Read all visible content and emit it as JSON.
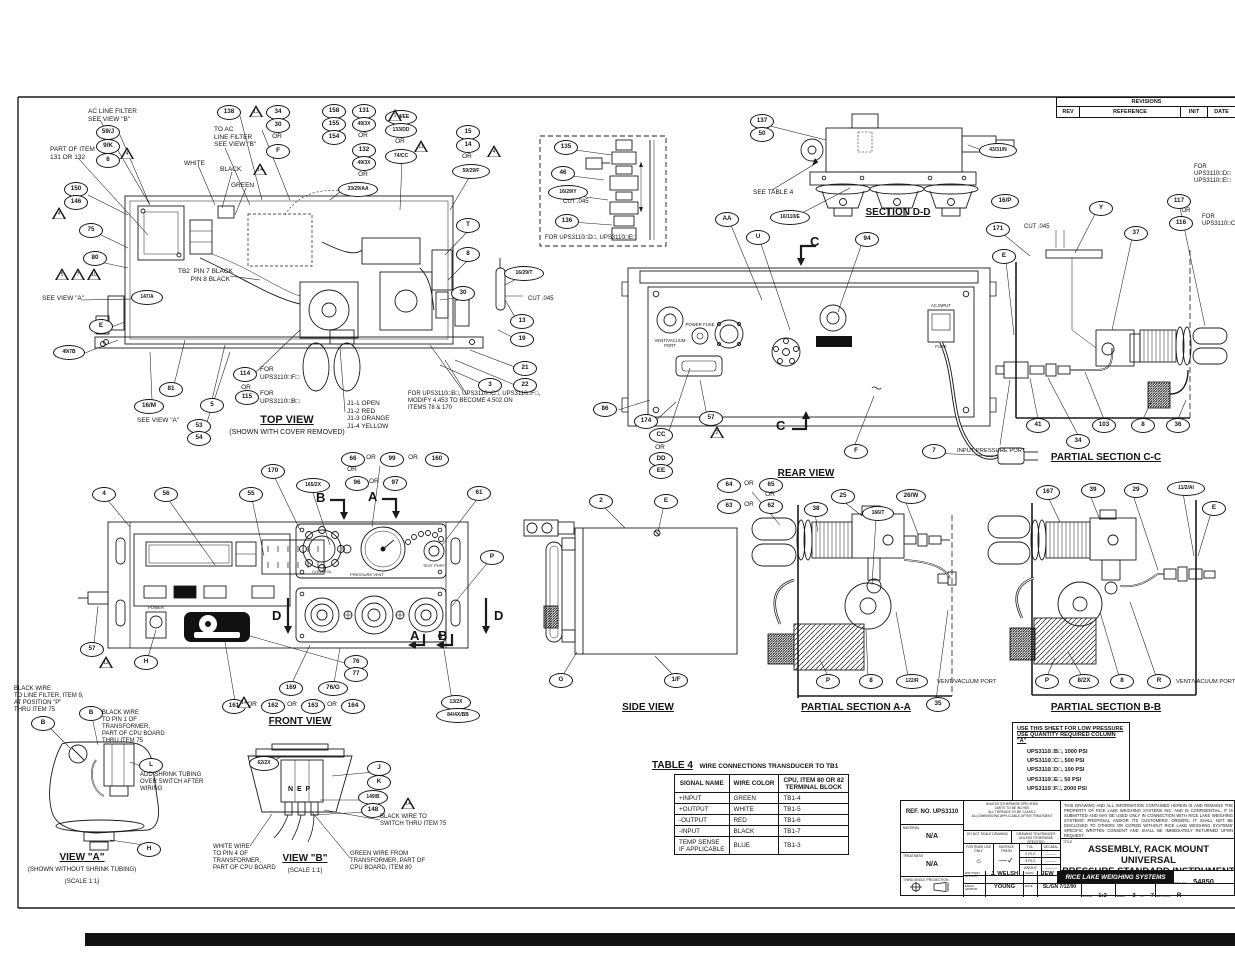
{
  "revisions": {
    "title": "REVISIONS",
    "cols": [
      "REV",
      "REFERENCE",
      "INIT",
      "DATE"
    ]
  },
  "table4": {
    "title": "TABLE 4",
    "subtitle": "WIRE CONNECTIONS TRANSDUCER TO TB1",
    "headers": [
      "SIGNAL NAME",
      "WIRE COLOR",
      "CPU, ITEM 80 OR 82\nTERMINAL BLOCK"
    ],
    "rows": [
      [
        "+INPUT",
        "GREEN",
        "TB1-4"
      ],
      [
        "+OUTPUT",
        "WHITE",
        "TB1-5"
      ],
      [
        "-OUTPUT",
        "RED",
        "TB1-6"
      ],
      [
        "-INPUT",
        "BLACK",
        "TB1-7"
      ],
      [
        "TEMP SENSE\nIF APPLICABLE",
        "BLUE",
        "TB1-3"
      ]
    ]
  },
  "low_pressure": {
    "header1": "USE THIS SHEET FOR LOW PRESSURE",
    "header2": "USE QUANTITY REQUIRED COLUMN \"A\"",
    "items": [
      "UPS3110□B□, 1000 PSI",
      "UPS3110□C□, 500 PSI",
      "UPS3110□D□, 100 PSI",
      "UPS3110□E□, 50 PSI",
      "UPS3110□F□, 2000 PSI"
    ]
  },
  "title_block": {
    "ref_no": "REF. NO. UPS3110",
    "material_label": "MATERIAL",
    "material": "N/A",
    "treatment_label": "TREATMENT",
    "treatment": "N/A",
    "projection_label": "THIRD ANGLE PROJECTION",
    "spec_note": "UNLESS OTHERWISE SPECIFIED\nLIMITS TO BE INCHES\nALL THREADS TO BE CLASS 2\nALL DIMENSIONS APPLICABLE AFTER TREATMENT",
    "do_not_scale": "DO NOT SCALE DRAWING",
    "tolerances_header": "DRAWING TOLERANCES UNLESS OTHERWISE SPECIFIED",
    "rlws_use": "FOR RLWS USE ONLY",
    "surface_finish": "SURFACE FINISH",
    "tol_label": "TOL.",
    "decimal_label": "DECIMAL",
    "tol_rows": [
      [
        "2 PLC",
        "———"
      ],
      [
        "3 PLC",
        "———"
      ],
      [
        "ANGLE",
        "———"
      ]
    ],
    "legal": "THIS DRAWING AND ALL INFORMATION CONTAINED HEREIN IS AND REMAINS THE PROPERTY OF RICE LAKE WEIGHING SYSTEMS INC. AND IS CONFIDENTIAL. IT IS SUBMITTED AND MAY BE USED ONLY IN CONNECTION WITH RICE LAKE WEIGHING SYSTEMS' PROPOSAL AND/OR ITS CUSTOMERS' ORDERS. IT SHALL NOT BE DISCLOSED TO OTHERS OR COPIED WITHOUT RICE LAKE WEIGHING SYSTEMS' SPECIFIC WRITTEN CONSENT AND SHALL BE IMMEDIATELY RETURNED UPON REQUEST.",
    "title_label": "TITLE",
    "title_line1": "ASSEMBLY, RACK MOUNT UNIVERSAL",
    "title_line2": "PRESSURE STANDARD INSTRUMENT",
    "company": "RICE LAKE WEIGHING SYSTEMS",
    "dwg_no_label": "DWG NO",
    "dwg_no": "54850",
    "drftsmn_label": "DRFTSMN APPRVD",
    "drftsmn": "J. WELSH",
    "chk_label": "CHKD",
    "chk": "JEW",
    "engr_label": "ENGR APPRVD",
    "engr": "YOUNG",
    "date_label": "DATE",
    "date": "SL/GN 7/12/90",
    "scale_label": "SCALE",
    "scale": "1:2",
    "sheet_label": "SHEET",
    "sheet": "3",
    "of_label": "OF",
    "sheet_total": "7",
    "revision_label": "REVISION",
    "revision": "R"
  },
  "annotations": [
    {
      "t": "AC LINE FILTER\nSEE VIEW \"B\"",
      "x": 88,
      "y": 108
    },
    {
      "t": "PART OF ITEM\n131 OR 132",
      "x": 50,
      "y": 146
    },
    {
      "t": "TO AC\nLINE FILTER\nSEE VIEW \"B\"",
      "x": 214,
      "y": 126
    },
    {
      "t": "WHITE",
      "x": 184,
      "y": 160
    },
    {
      "t": "BLACK",
      "x": 220,
      "y": 166
    },
    {
      "t": "GREEN",
      "x": 231,
      "y": 182
    },
    {
      "t": "TB2  PIN 7 BLACK\n       PIN 8 BLACK",
      "x": 178,
      "y": 268
    },
    {
      "t": "SEE VIEW \"A\"",
      "x": 42,
      "y": 295
    },
    {
      "t": "SEE VIEW \"A\"",
      "x": 137,
      "y": 417
    },
    {
      "t": "FOR\nUPS3110□F□",
      "x": 260,
      "y": 366
    },
    {
      "t": "OR",
      "x": 246,
      "y": 384,
      "c": 1
    },
    {
      "t": "FOR\nUPS3110□B□",
      "x": 260,
      "y": 390
    },
    {
      "t": "TOP VIEW",
      "x": 287,
      "y": 414,
      "s": 11,
      "u": 1,
      "b": 1,
      "c": 1,
      "n": "top-view-label"
    },
    {
      "t": "(SHOWN WITH COVER REMOVED)",
      "x": 287,
      "y": 429,
      "s": 7,
      "c": 1
    },
    {
      "t": "J1-1 OPEN\nJ1-2 RED\nJ1-3 ORANGE\nJ1-4 YELLOW",
      "x": 347,
      "y": 400
    },
    {
      "t": "FOR UPS3110□B□, UPS3110□C□, UPS3110□F□,\nMODIFY 4.453 TO BECOME 4.502 ON\nITEMS 78 & 170",
      "x": 408,
      "y": 391,
      "s": 6
    },
    {
      "t": "CUT .045",
      "x": 528,
      "y": 296,
      "s": 6
    },
    {
      "t": "CUT .045",
      "x": 563,
      "y": 199,
      "s": 6
    },
    {
      "t": "CUT .045",
      "x": 1024,
      "y": 224,
      "s": 6
    },
    {
      "t": "FOR UPS3110□D□, UPS3110□E□",
      "x": 545,
      "y": 235,
      "s": 6
    },
    {
      "t": "SEE TABLE 4",
      "x": 753,
      "y": 189
    },
    {
      "t": "SECTION D-D",
      "x": 898,
      "y": 207,
      "s": 10,
      "u": 1,
      "b": 1,
      "c": 1,
      "n": "section-dd-label"
    },
    {
      "t": "REAR VIEW",
      "x": 806,
      "y": 468,
      "s": 10,
      "u": 1,
      "b": 1,
      "c": 1,
      "n": "rear-view-label"
    },
    {
      "t": "PARTIAL SECTION C-C",
      "x": 1106,
      "y": 452,
      "s": 10,
      "u": 1,
      "b": 1,
      "c": 1,
      "n": "partial-section-cc-label"
    },
    {
      "t": "INPUT PRESSURE PORT",
      "x": 957,
      "y": 448,
      "s": 5.8
    },
    {
      "t": "SIDE VIEW",
      "x": 648,
      "y": 702,
      "s": 10,
      "u": 1,
      "b": 1,
      "c": 1,
      "n": "side-view-label"
    },
    {
      "t": "PARTIAL SECTION A-A",
      "x": 856,
      "y": 702,
      "s": 10,
      "u": 1,
      "b": 1,
      "c": 1,
      "n": "partial-section-aa-label"
    },
    {
      "t": "PARTIAL SECTION B-B",
      "x": 1106,
      "y": 702,
      "s": 10,
      "u": 1,
      "b": 1,
      "c": 1,
      "n": "partial-section-bb-label"
    },
    {
      "t": "VENT/VACUUM PORT",
      "x": 937,
      "y": 679,
      "s": 5.8
    },
    {
      "t": "VENT/VACUUM PORT",
      "x": 1176,
      "y": 679,
      "s": 5.8
    },
    {
      "t": "FRONT VIEW",
      "x": 300,
      "y": 716,
      "s": 10,
      "u": 1,
      "b": 1,
      "c": 1,
      "n": "front-view-label"
    },
    {
      "t": "VIEW \"A\"",
      "x": 82,
      "y": 852,
      "s": 10,
      "u": 1,
      "b": 1,
      "c": 1,
      "n": "view-a-label"
    },
    {
      "t": "(SHOWN WITHOUT SHRINK TUBING)",
      "x": 82,
      "y": 866,
      "s": 6.2,
      "c": 1
    },
    {
      "t": "(SCALE 1:1)",
      "x": 82,
      "y": 878,
      "s": 6.2,
      "c": 1
    },
    {
      "t": "VIEW \"B\"",
      "x": 305,
      "y": 853,
      "s": 10,
      "u": 1,
      "b": 1,
      "c": 1,
      "n": "view-b-label"
    },
    {
      "t": "(SCALE 1:1)",
      "x": 305,
      "y": 867,
      "s": 6.2,
      "c": 1
    },
    {
      "t": "BLACK WIRE\nTO LINE FILTER, ITEM 9,\nAT POSITION \"P\"\nTHRU ITEM 75",
      "x": 14,
      "y": 686,
      "s": 6
    },
    {
      "t": "BLACK WIRE\nTO PIN 1 OF\nTRANSFORMER,\nPART OF CPU BOARD\nTHRU ITEM 75",
      "x": 102,
      "y": 710,
      "s": 6
    },
    {
      "t": "ADD SHRINK TUBING\nOVER SWITCH AFTER\nWIRING",
      "x": 140,
      "y": 772,
      "s": 6
    },
    {
      "t": "WHITE WIRE\nTO PIN 4 OF\nTRANSFORMER,\nPART OF CPU BOARD",
      "x": 213,
      "y": 844,
      "s": 6
    },
    {
      "t": "GREEN WIRE FROM\nTRANSFORMER, PART OF\nCPU BOARD, ITEM 80",
      "x": 350,
      "y": 851,
      "s": 6
    },
    {
      "t": "BLACK WIRE TO\nSWITCH THRU ITEM 75",
      "x": 380,
      "y": 814,
      "s": 6
    },
    {
      "t": "N  E  P",
      "x": 288,
      "y": 786,
      "s": 7,
      "b": 1
    },
    {
      "t": "VENT/VACUUM\nPORT",
      "x": 670,
      "y": 338,
      "s": 4.3,
      "c": 1
    },
    {
      "t": "POWER FUSE",
      "x": 700,
      "y": 322,
      "s": 4.3,
      "c": 1
    },
    {
      "t": "AC INPUT",
      "x": 941,
      "y": 303,
      "s": 4.3,
      "c": 1
    },
    {
      "t": "FUSE",
      "x": 941,
      "y": 344,
      "s": 4.3,
      "c": 1
    },
    {
      "t": "POWER",
      "x": 156,
      "y": 605,
      "s": 4.3,
      "c": 1
    },
    {
      "t": "CONTROL",
      "x": 322,
      "y": 570,
      "s": 4,
      "c": 1
    },
    {
      "t": "PRESSURE VENT",
      "x": 367,
      "y": 573,
      "s": 4,
      "c": 1
    },
    {
      "t": "TEST PORT",
      "x": 434,
      "y": 564,
      "s": 4,
      "c": 1
    },
    {
      "t": "FOR\nUPS3110□D□\nUPS3110□E□",
      "x": 1194,
      "y": 164,
      "s": 6
    },
    {
      "t": "OR",
      "x": 1186,
      "y": 208,
      "s": 6,
      "c": 1
    },
    {
      "t": "FOR\nUPS3110□C□",
      "x": 1202,
      "y": 214,
      "s": 6
    },
    {
      "t": "OR",
      "x": 277,
      "y": 133,
      "c": 1
    },
    {
      "t": "OR",
      "x": 363,
      "y": 132,
      "c": 1
    },
    {
      "t": "OR",
      "x": 363,
      "y": 171,
      "c": 1
    },
    {
      "t": "OR",
      "x": 400,
      "y": 138,
      "c": 1
    },
    {
      "t": "OR",
      "x": 467,
      "y": 153,
      "c": 1
    },
    {
      "t": "OR",
      "x": 660,
      "y": 444,
      "c": 1
    },
    {
      "t": "OR",
      "x": 371,
      "y": 454,
      "c": 1
    },
    {
      "t": "OR",
      "x": 413,
      "y": 454,
      "c": 1
    },
    {
      "t": "OR",
      "x": 352,
      "y": 466,
      "c": 1
    },
    {
      "t": "OR",
      "x": 374,
      "y": 478,
      "c": 1
    },
    {
      "t": "OR",
      "x": 749,
      "y": 480,
      "c": 1
    },
    {
      "t": "OR",
      "x": 770,
      "y": 491,
      "c": 1
    },
    {
      "t": "OR",
      "x": 749,
      "y": 501,
      "c": 1
    },
    {
      "t": "OR",
      "x": 252,
      "y": 701,
      "c": 1
    },
    {
      "t": "OR",
      "x": 292,
      "y": 701,
      "c": 1
    },
    {
      "t": "OR",
      "x": 332,
      "y": 701,
      "c": 1
    },
    {
      "t": "B",
      "x": 316,
      "y": 490,
      "s": 13,
      "b": 1,
      "n": "section-arrow-b-top"
    },
    {
      "t": "A",
      "x": 368,
      "y": 489,
      "s": 13,
      "b": 1,
      "n": "section-arrow-a-top"
    },
    {
      "t": "D",
      "x": 272,
      "y": 608,
      "s": 13,
      "b": 1,
      "n": "section-arrow-d-left"
    },
    {
      "t": "D",
      "x": 494,
      "y": 608,
      "s": 13,
      "b": 1,
      "n": "section-arrow-d-right"
    },
    {
      "t": "A",
      "x": 410,
      "y": 628,
      "s": 13,
      "b": 1,
      "n": "section-arrow-a-bottom"
    },
    {
      "t": "B",
      "x": 438,
      "y": 628,
      "s": 13,
      "b": 1,
      "n": "section-arrow-b-bottom"
    },
    {
      "t": "C",
      "x": 810,
      "y": 234,
      "s": 13,
      "b": 1,
      "n": "section-arrow-c-top"
    },
    {
      "t": "C",
      "x": 776,
      "y": 418,
      "s": 13,
      "b": 1,
      "n": "section-arrow-c-bottom"
    }
  ],
  "balloons": [
    [
      "59/J",
      107,
      131
    ],
    [
      "9/K",
      107,
      145
    ],
    [
      "6",
      107,
      159
    ],
    [
      "138",
      228,
      111
    ],
    [
      "34",
      277,
      111
    ],
    [
      "30",
      277,
      124
    ],
    [
      "F",
      277,
      150
    ],
    [
      "158",
      333,
      110
    ],
    [
      "155",
      333,
      123
    ],
    [
      "154",
      333,
      136
    ],
    [
      "131",
      363,
      110
    ],
    [
      "49/3X",
      363,
      123
    ],
    [
      "132",
      363,
      149
    ],
    [
      "49/3X",
      363,
      162
    ],
    [
      "33/29/AA",
      357,
      188,
      38
    ],
    [
      "134/EE",
      400,
      116,
      30
    ],
    [
      "133/DD",
      400,
      129,
      30
    ],
    [
      "74/CC",
      400,
      155,
      30
    ],
    [
      "15",
      467,
      131
    ],
    [
      "14",
      467,
      144
    ],
    [
      "59/29/F",
      470,
      170,
      36
    ],
    [
      "150",
      75,
      188
    ],
    [
      "146",
      75,
      201
    ],
    [
      "75",
      90,
      229
    ],
    [
      "80",
      94,
      257
    ],
    [
      "147/A",
      146,
      296,
      30
    ],
    [
      "E",
      100,
      325
    ],
    [
      "49/7B",
      68,
      351,
      30
    ],
    [
      "16/M",
      148,
      405,
      28
    ],
    [
      "81",
      170,
      388
    ],
    [
      "5",
      211,
      404
    ],
    [
      "53",
      198,
      425
    ],
    [
      "54",
      198,
      437
    ],
    [
      "114",
      244,
      373
    ],
    [
      "115",
      246,
      396
    ],
    [
      "T",
      467,
      224
    ],
    [
      "8",
      467,
      253
    ],
    [
      "30",
      462,
      292
    ],
    [
      "16/29/T",
      523,
      272,
      38
    ],
    [
      "13",
      521,
      320
    ],
    [
      "19",
      521,
      338
    ],
    [
      "21",
      524,
      367
    ],
    [
      "22",
      524,
      384
    ],
    [
      "3",
      489,
      384
    ],
    [
      "135",
      565,
      146
    ],
    [
      "46",
      562,
      172
    ],
    [
      "16/29/Y",
      567,
      191,
      38
    ],
    [
      "136",
      566,
      220
    ],
    [
      "137",
      761,
      120
    ],
    [
      "50",
      761,
      133
    ],
    [
      "43/31/N",
      997,
      149,
      36
    ],
    [
      "16/110/E",
      789,
      216,
      38
    ],
    [
      "16/P",
      1004,
      200,
      26
    ],
    [
      "AA",
      726,
      218
    ],
    [
      "U",
      757,
      236
    ],
    [
      "94",
      866,
      238
    ],
    [
      "86",
      604,
      408
    ],
    [
      "174",
      645,
      420
    ],
    [
      "57",
      710,
      417
    ],
    [
      "CC",
      660,
      434
    ],
    [
      "DD",
      660,
      458
    ],
    [
      "EE",
      660,
      470
    ],
    [
      "F",
      855,
      450
    ],
    [
      "7",
      933,
      450
    ],
    [
      "171",
      997,
      228
    ],
    [
      "Y",
      1100,
      207
    ],
    [
      "E",
      1003,
      255
    ],
    [
      "37",
      1135,
      232
    ],
    [
      "117",
      1178,
      200
    ],
    [
      "116",
      1180,
      222
    ],
    [
      "41",
      1037,
      424
    ],
    [
      "34",
      1077,
      440
    ],
    [
      "103",
      1103,
      424
    ],
    [
      "8",
      1142,
      424
    ],
    [
      "36",
      1177,
      424
    ],
    [
      "4",
      103,
      493
    ],
    [
      "56",
      165,
      493
    ],
    [
      "55",
      250,
      493
    ],
    [
      "170",
      272,
      470
    ],
    [
      "165/2X",
      312,
      484,
      32
    ],
    [
      "66",
      352,
      458
    ],
    [
      "99",
      391,
      458
    ],
    [
      "160",
      436,
      458
    ],
    [
      "96",
      356,
      482
    ],
    [
      "97",
      394,
      482
    ],
    [
      "61",
      478,
      492
    ],
    [
      "P",
      491,
      556
    ],
    [
      "57",
      91,
      648
    ],
    [
      "H",
      145,
      661
    ],
    [
      "76",
      355,
      661
    ],
    [
      "77",
      355,
      673
    ],
    [
      "169",
      290,
      687
    ],
    [
      "76/G",
      332,
      687,
      28
    ],
    [
      "161",
      233,
      705
    ],
    [
      "162",
      272,
      705
    ],
    [
      "163",
      312,
      705
    ],
    [
      "164",
      352,
      705
    ],
    [
      "13/2X",
      455,
      701,
      28
    ],
    [
      "84/4X/BB",
      457,
      714,
      42
    ],
    [
      "2",
      600,
      500
    ],
    [
      "E",
      665,
      500
    ],
    [
      "G",
      560,
      679
    ],
    [
      "1/F",
      675,
      679
    ],
    [
      "64",
      728,
      484
    ],
    [
      "65",
      770,
      484
    ],
    [
      "63",
      728,
      505
    ],
    [
      "62",
      770,
      505
    ],
    [
      "38",
      815,
      508
    ],
    [
      "25",
      842,
      495
    ],
    [
      "166/T",
      877,
      512,
      30
    ],
    [
      "26/W",
      910,
      495,
      28
    ],
    [
      "P",
      827,
      680
    ],
    [
      "8",
      870,
      680
    ],
    [
      "122/R",
      911,
      680,
      30
    ],
    [
      "35",
      937,
      703
    ],
    [
      "167",
      1047,
      491
    ],
    [
      "39",
      1092,
      489
    ],
    [
      "29",
      1135,
      489
    ],
    [
      "11/2/AI",
      1185,
      487,
      36
    ],
    [
      "E",
      1213,
      507
    ],
    [
      "P",
      1046,
      680
    ],
    [
      "8/2X",
      1083,
      680,
      28
    ],
    [
      "8",
      1121,
      680
    ],
    [
      "R",
      1158,
      680
    ],
    [
      "B",
      42,
      722
    ],
    [
      "B",
      90,
      712
    ],
    [
      "L",
      150,
      764
    ],
    [
      "H",
      148,
      848
    ],
    [
      "62/2X",
      263,
      762,
      28
    ],
    [
      "J",
      378,
      767
    ],
    [
      "K",
      378,
      781
    ],
    [
      "149/B",
      372,
      796,
      28
    ],
    [
      "148",
      372,
      809
    ]
  ],
  "triangles": [
    [
      "13",
      249,
      105
    ],
    [
      "14",
      253,
      163
    ],
    [
      "4",
      120,
      147
    ],
    [
      "4",
      52,
      207
    ],
    [
      "5",
      55,
      268
    ],
    [
      "7",
      71,
      268
    ],
    [
      "10",
      87,
      268
    ],
    [
      "1",
      388,
      109
    ],
    [
      "11",
      414,
      140
    ],
    [
      "4",
      487,
      145
    ],
    [
      "2",
      710,
      426
    ],
    [
      "12",
      99,
      656
    ],
    [
      "14",
      237,
      696
    ],
    [
      "14",
      401,
      797
    ]
  ]
}
